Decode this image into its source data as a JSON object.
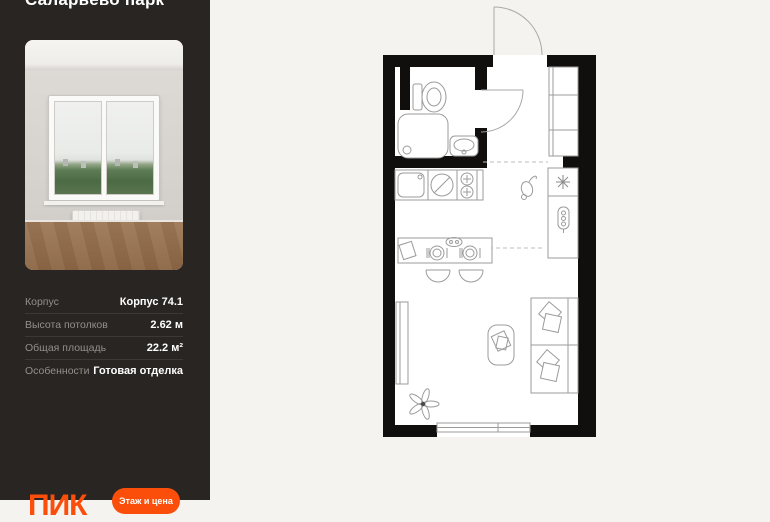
{
  "sidebar": {
    "title": "Саларьево парк",
    "photo": {
      "description": "room with window, radiator and wood floor"
    },
    "specs": [
      {
        "label": "Корпус",
        "value": "Корпус 74.1"
      },
      {
        "label": "Высота потолков",
        "value": "2.62 м"
      },
      {
        "label": "Общая площадь",
        "value": "22.2 м²"
      },
      {
        "label": "Особенности",
        "value": "Готовая отделка"
      }
    ],
    "brand": "ПИК",
    "cta_label": "Этаж и цена"
  },
  "floor_plan": {
    "symbols": [
      "entrance-door",
      "bathroom-door",
      "toilet",
      "shower-cabin",
      "washbasin",
      "kitchen-sink",
      "hob-burners",
      "fridge-snowflake",
      "water-heater",
      "hallway-closet",
      "bar-table",
      "place-settings",
      "chairs",
      "armchair",
      "bed-with-pillows",
      "wardrobe",
      "plant",
      "window"
    ]
  },
  "colors": {
    "accent_orange": "#fb4e0a",
    "sidebar_bg": "#292522",
    "page_bg": "#f5f3f0",
    "plan_walls": "#100f0d"
  }
}
